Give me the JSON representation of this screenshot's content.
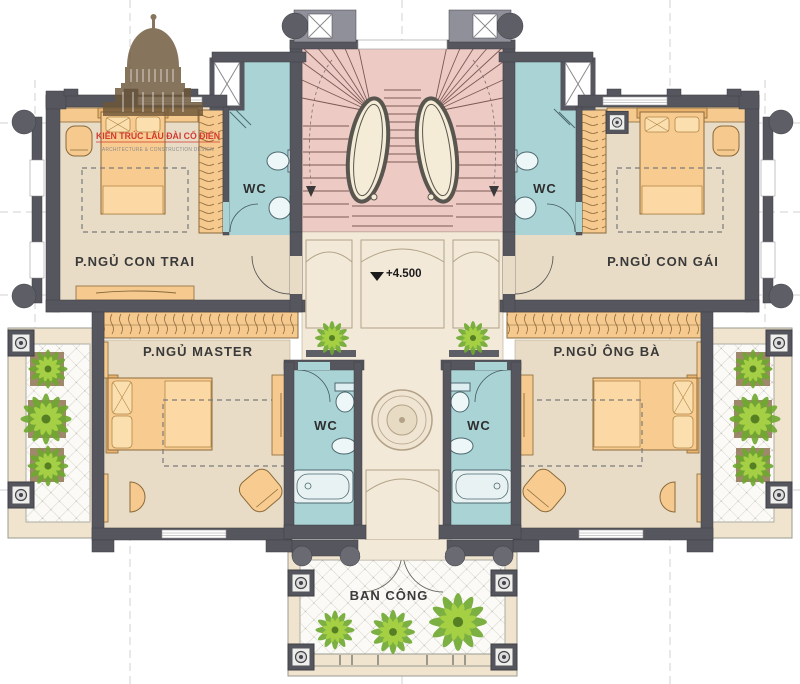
{
  "logo": {
    "title": "KIẾN TRÚC LÂU ĐÀI CỔ ĐIỂN",
    "subtitle": "ARCHITECTURE & CONSTRUCTION DESIGN"
  },
  "labels": {
    "bedroom_son": "P.NGỦ CON TRAI",
    "bedroom_daughter": "P.NGỦ CON GÁI",
    "bedroom_master": "P.NGỦ MASTER",
    "bedroom_grandparents": "P.NGỦ ÔNG BÀ",
    "wc": "WC",
    "balcony": "BAN CÔNG",
    "elevation": "+4.500"
  },
  "colors": {
    "wall": "#56565e",
    "bedroom_floor": "#e9dcc6",
    "hall_floor": "#f2e9d9",
    "wc_floor": "#aad3d5",
    "stair_floor": "#eecac5",
    "furniture": "#f8cb90",
    "terrace_frame": "#f0e4cf",
    "plant_green": "#6fa930",
    "logo_red": "#d23a30"
  }
}
